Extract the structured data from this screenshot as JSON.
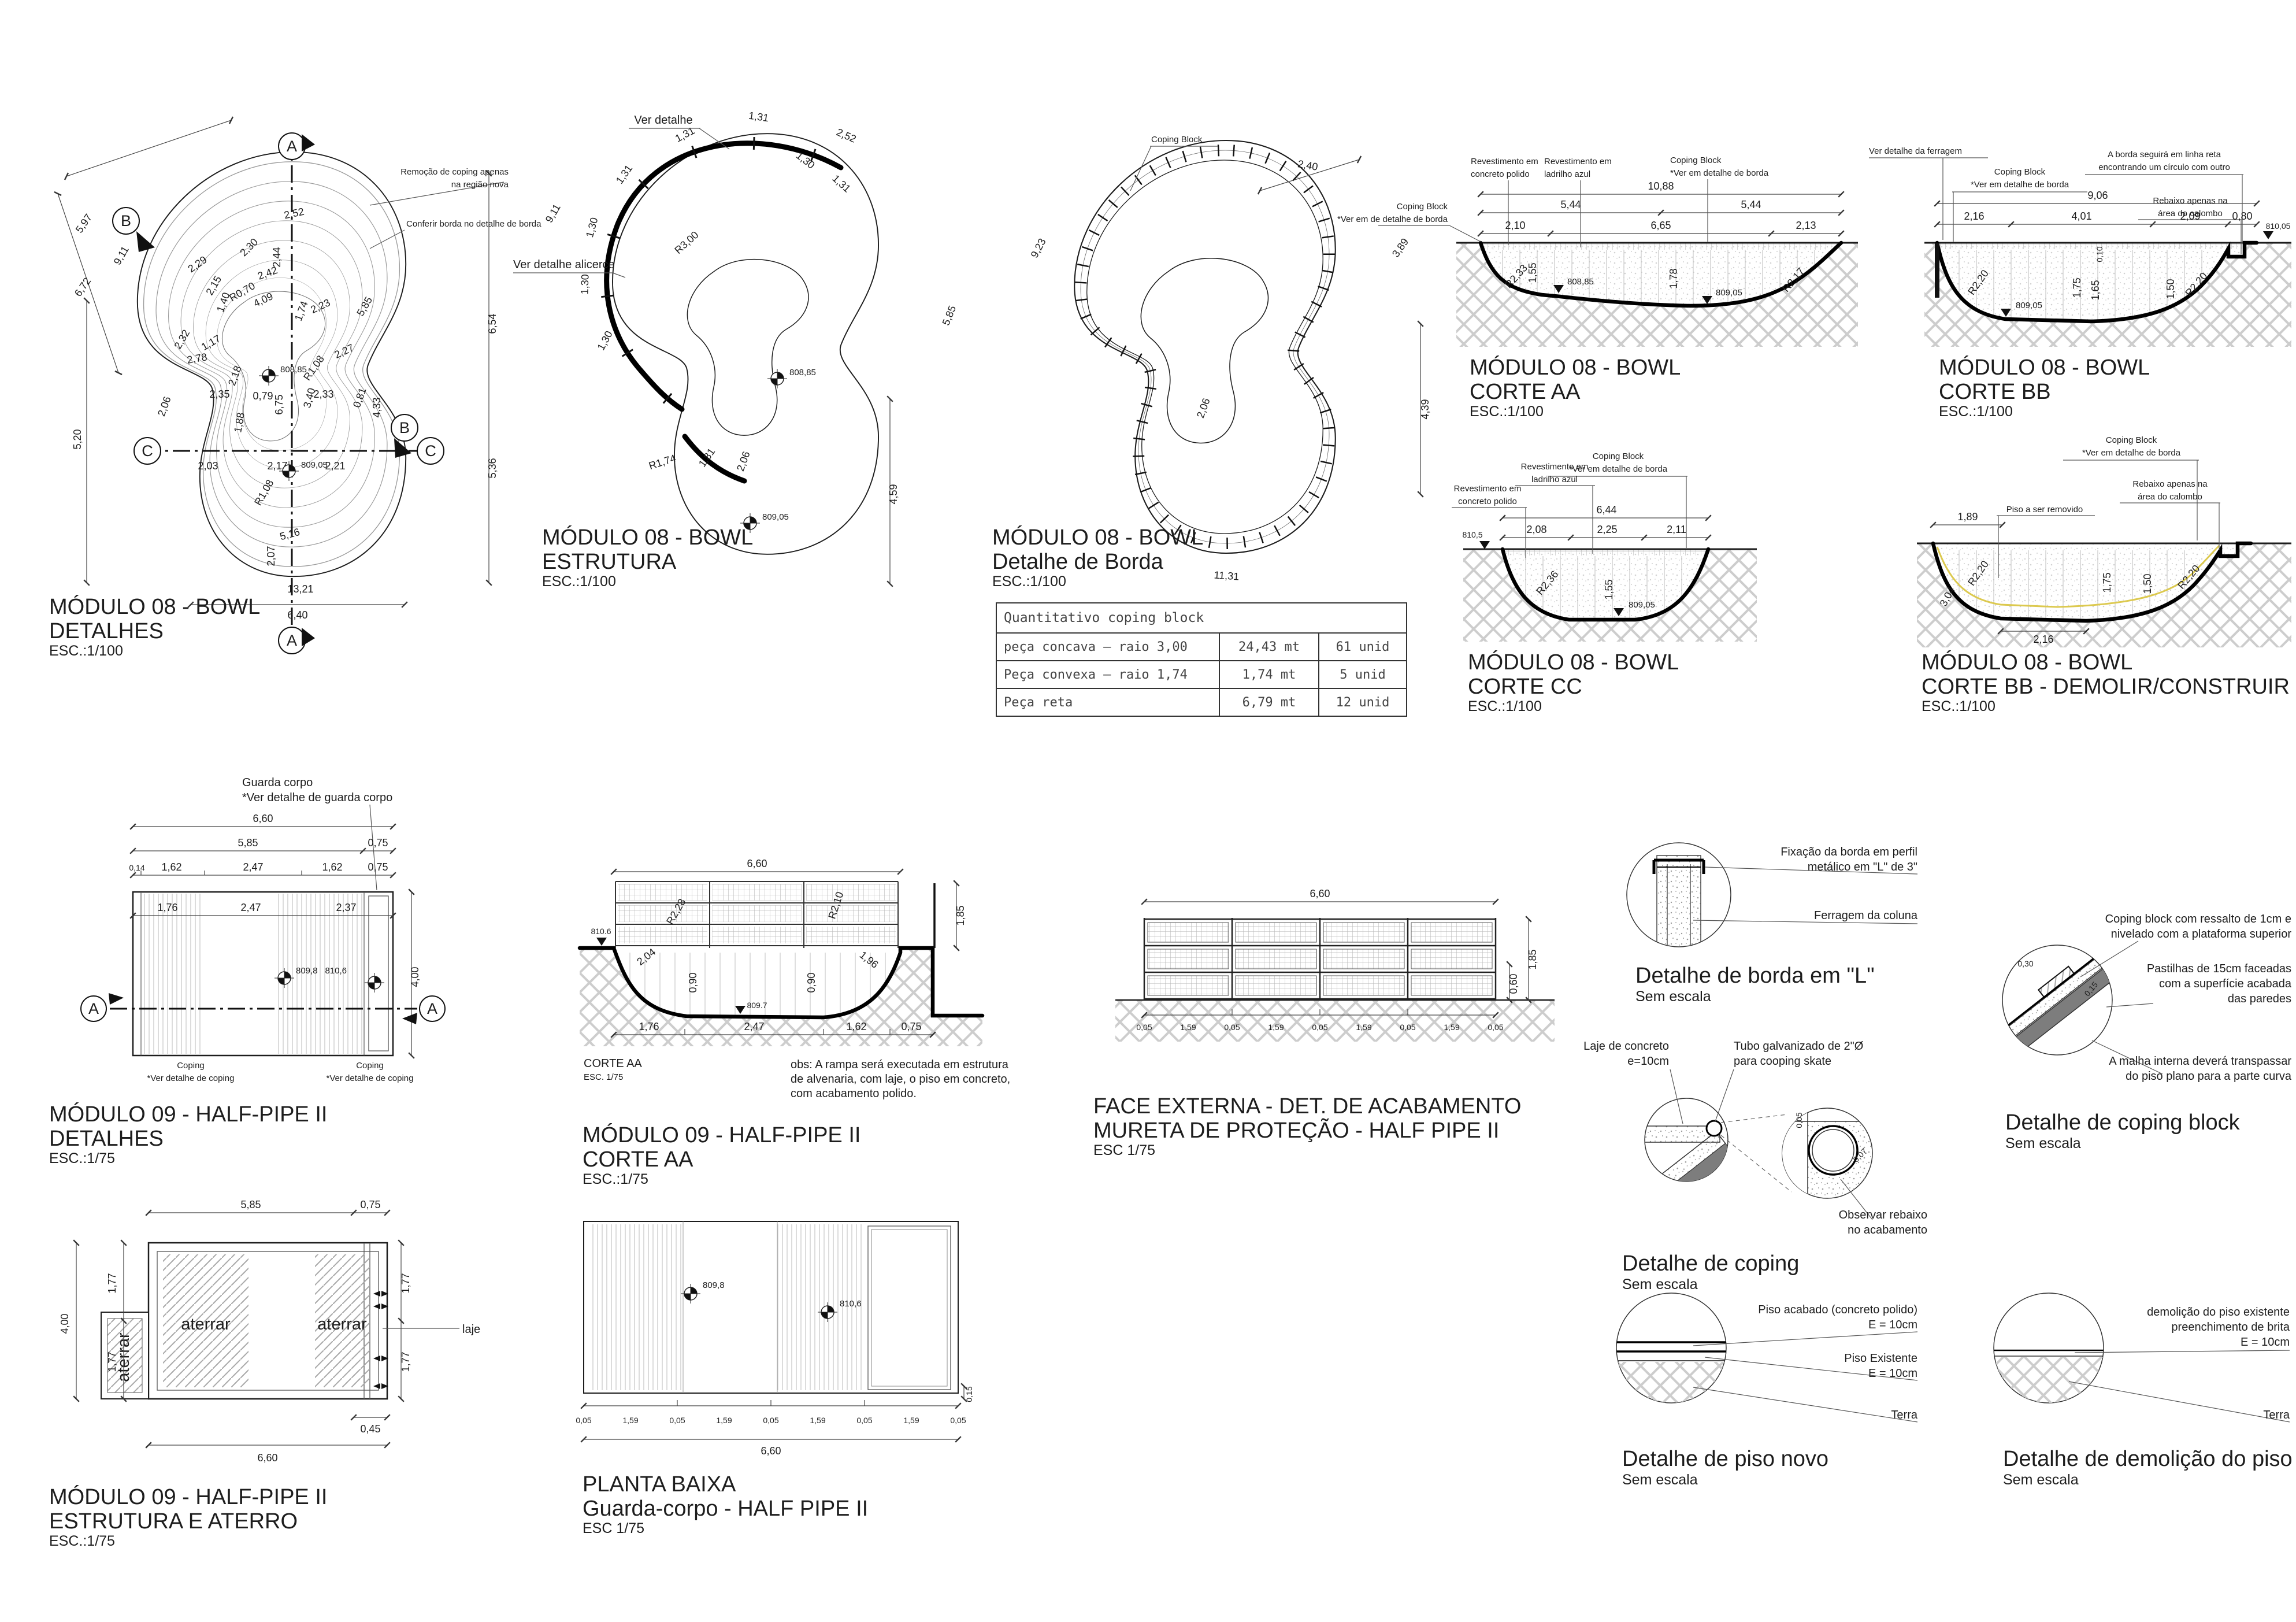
{
  "colors": {
    "background": "#ffffff",
    "linework": "#1d1d1d",
    "hatch_gray": "#cccccc",
    "existing_profile_yellow": "#dcc94f"
  },
  "markers": {
    "A": "A",
    "B": "B",
    "C": "C"
  },
  "p1": {
    "t": [
      "MÓDULO 08 - BOWL",
      "DETALHES",
      "ESC.:1/100"
    ],
    "notes": [
      "Remoção de coping apenas",
      "na região nova",
      "Conferir borda no detalhe de borda"
    ],
    "levels": [
      "808,85",
      "809,05"
    ],
    "dims": [
      "5,97",
      "9,11",
      "6,72",
      "2,52",
      "2,30",
      "2,44",
      "2,29",
      "2,15",
      "2,42",
      "1,40",
      "R0,70",
      "4,09",
      "1,74",
      "2,23",
      "5,85",
      "6,54",
      "2,32",
      "1,17",
      "2,78",
      "2,18",
      "R1,08",
      "2,27",
      "6,75",
      "3,40",
      "2,35",
      "0,79",
      "2,33",
      "0,81",
      "4,33",
      "2,06",
      "1,88",
      "5,20",
      "5,36",
      "2,03",
      "2,17",
      "2,21",
      "R1,08",
      "5,16",
      "2,07",
      "13,21",
      "6,40"
    ]
  },
  "p2": {
    "t": [
      "MÓDULO 08 - BOWL",
      "ESTRUTURA",
      "ESC.:1/100"
    ],
    "notes": [
      "Ver detalhe",
      "Ver detalhe alicerce"
    ],
    "levels": [
      "808,85",
      "809,05"
    ],
    "dims": [
      "1,31",
      "1,31",
      "1,31",
      "1,30",
      "1,30",
      "1,30",
      "2,52",
      "1,30",
      "1,31",
      "9,11",
      "R3,00",
      "R1,74",
      "1,81",
      "2,06",
      "5,85",
      "4,59"
    ]
  },
  "p3": {
    "t": [
      "MÓDULO 08 - BOWL",
      "Detalhe de Borda",
      "ESC.:1/100"
    ],
    "note": "Coping Block",
    "dims": [
      "2,40",
      "9,23",
      "3,89",
      "2,06",
      "4,39",
      "11,31"
    ]
  },
  "tb": {
    "title": "Quantitativo coping block",
    "rows": [
      {
        "desc": "peça concava – raio 3,00",
        "len": "24,43 mt",
        "qty": "61 unid"
      },
      {
        "desc": "Peça convexa – raio 1,74",
        "len": "1,74 mt",
        "qty": "5 unid"
      },
      {
        "desc": "Peça reta",
        "len": "6,79 mt",
        "qty": "12 unid"
      }
    ]
  },
  "aa": {
    "t": [
      "MÓDULO 08 - BOWL",
      "CORTE AA",
      "ESC.:1/100"
    ],
    "labels": [
      "Coping Block",
      "*Ver em de detalhe de borda",
      "Revestimento em",
      "concreto polido",
      "Revestimento em",
      "ladrilho azul",
      "Coping Block",
      "*Ver em detalhe de borda"
    ],
    "levels": [
      "808,85",
      "809,05"
    ],
    "dims": [
      "10,88",
      "5,44",
      "5,44",
      "2,10",
      "6,65",
      "2,13",
      "R2,33",
      "1,55",
      "1,78",
      "R2,17"
    ]
  },
  "bb": {
    "t": [
      "MÓDULO 08 - BOWL",
      "CORTE BB",
      "ESC.:1/100"
    ],
    "labels": [
      "Ver detalhe da ferragem",
      "Coping Block",
      "*Ver em detalhe de borda",
      "A borda seguirá em linha reta",
      "encontrando um círculo com outro",
      "Rebaixo apenas na",
      "área do calombo"
    ],
    "levels": [
      "809,05",
      "810,05"
    ],
    "dims": [
      "9,06",
      "2,16",
      "4,01",
      "2,09",
      "0,80",
      "R2,20",
      "0,10",
      "1,75",
      "1,65",
      "1,50",
      "R2,20"
    ]
  },
  "cc": {
    "t": [
      "MÓDULO 08 - BOWL",
      "CORTE CC",
      "ESC.:1/100"
    ],
    "labels": [
      "Coping Block",
      "*Ver em detalhe de borda",
      "Revestimento em",
      "ladrilho azul",
      "Revestimento em",
      "concreto polido"
    ],
    "levels": [
      "810,5",
      "809,05"
    ],
    "dims": [
      "6,44",
      "2,08",
      "2,25",
      "2,11",
      "R2,36",
      "1,55"
    ]
  },
  "bd": {
    "t": [
      "MÓDULO 08 - BOWL",
      "CORTE BB - DEMOLIR/CONSTRUIR",
      "ESC.:1/100"
    ],
    "labels": [
      "Coping Block",
      "*Ver em detalhe de borda",
      "Rebaixo apenas na",
      "área do calombo",
      "Piso a ser removido"
    ],
    "dims": [
      "1,89",
      "R2,20",
      "3,04",
      "2,16",
      "1,75",
      "1,50",
      "R2,20"
    ]
  },
  "m9d": {
    "t": [
      "MÓDULO 09 - HALF-PIPE II",
      "DETALHES",
      "ESC.:1/75"
    ],
    "labels": [
      "Guarda corpo",
      "*Ver detalhe de guarda corpo",
      "Coping",
      "*Ver detalhe de coping",
      "Coping",
      "*Ver detalhe de coping"
    ],
    "levels": [
      "809,8",
      "810,6"
    ],
    "dims": [
      "6,60",
      "5,85",
      "0,75",
      "0,14",
      "1,62",
      "2,47",
      "1,62",
      "0,75",
      "1,76",
      "2,47",
      "2,37",
      "4,00"
    ]
  },
  "m9c": {
    "t": [
      "MÓDULO 09 - HALF-PIPE II",
      "CORTE AA",
      "ESC.:1/75"
    ],
    "sub": [
      "CORTE AA",
      "ESC. 1/75"
    ],
    "obs": [
      "obs: A rampa será executada em estrutura",
      "de alvenaria, com laje, o piso em concreto,",
      "com acabamento polido."
    ],
    "levels": [
      "810.6",
      "809.7"
    ],
    "dims": [
      "6,60",
      "R2,28",
      "R2,10",
      "2,04",
      "0,90",
      "0,90",
      "1,96",
      "1,85",
      "1,76",
      "2,47",
      "1,62",
      "0,75"
    ]
  },
  "fe": {
    "t": [
      "FACE EXTERNA - DET. DE ACABAMENTO",
      "MURETA DE PROTEÇÃO - HALF PIPE II",
      "ESC 1/75"
    ],
    "dims": [
      "6,60",
      "1,85",
      "0,60",
      "0,05",
      "1,59",
      "0,05",
      "1,59",
      "0,05",
      "1,59",
      "0,05",
      "1,59",
      "0,05"
    ]
  },
  "m9e": {
    "t": [
      "MÓDULO 09 - HALF-PIPE II",
      "ESTRUTURA E ATERRO",
      "ESC.:1/75"
    ],
    "labels": [
      "aterrar",
      "aterrar",
      "aterrar",
      "laje"
    ],
    "dims": [
      "5,85",
      "0,75",
      "1,77",
      "1,77",
      "1,77",
      "1,77",
      "4,00",
      "0,45",
      "6,60"
    ]
  },
  "pb": {
    "t": [
      "PLANTA BAIXA",
      "Guarda-corpo - HALF PIPE II",
      "ESC 1/75"
    ],
    "levels": [
      "809,8",
      "810,6"
    ],
    "dims": [
      "0,05",
      "1,59",
      "0,05",
      "1,59",
      "0,05",
      "1,59",
      "0,05",
      "1,59",
      "0,05",
      "6,60",
      "0,15"
    ]
  },
  "dl": {
    "t": [
      "Detalhe de borda em \"L\"",
      "Sem escala"
    ],
    "labels": [
      "Fixação da borda em perfil",
      "metálico em \"L\" de 3\"",
      "Ferragem da coluna"
    ]
  },
  "dcb": {
    "t": [
      "Detalhe de coping block",
      "Sem escala"
    ],
    "labels": [
      "Coping block com ressalto de 1cm e",
      "nivelado com a plataforma superior",
      "Pastilhas de 15cm faceadas",
      "com a superfície acabada",
      "das paredes",
      "A malha interna deverá transpassar",
      "do piso plano para a parte curva"
    ],
    "dims": [
      "0,30",
      "0,15"
    ]
  },
  "dc": {
    "t": [
      "Detalhe de coping",
      "Sem escala"
    ],
    "labels": [
      "Laje de concreto",
      "e=10cm",
      "Tubo galvanizado de 2\"Ø",
      "para cooping skate",
      "Observar rebaixo",
      "no acabamento"
    ],
    "dims": [
      "0,05",
      "0,07"
    ]
  },
  "dpn": {
    "t": [
      "Detalhe de piso novo",
      "Sem escala"
    ],
    "labels": [
      "Piso acabado (concreto polido)",
      "E = 10cm",
      "Piso Existente",
      "E = 10cm",
      "Terra"
    ]
  },
  "dd": {
    "t": [
      "Detalhe de demolição do piso",
      "Sem escala"
    ],
    "labels": [
      "demolição do piso existente",
      "preenchimento de brita",
      "E = 10cm",
      "Terra"
    ]
  }
}
